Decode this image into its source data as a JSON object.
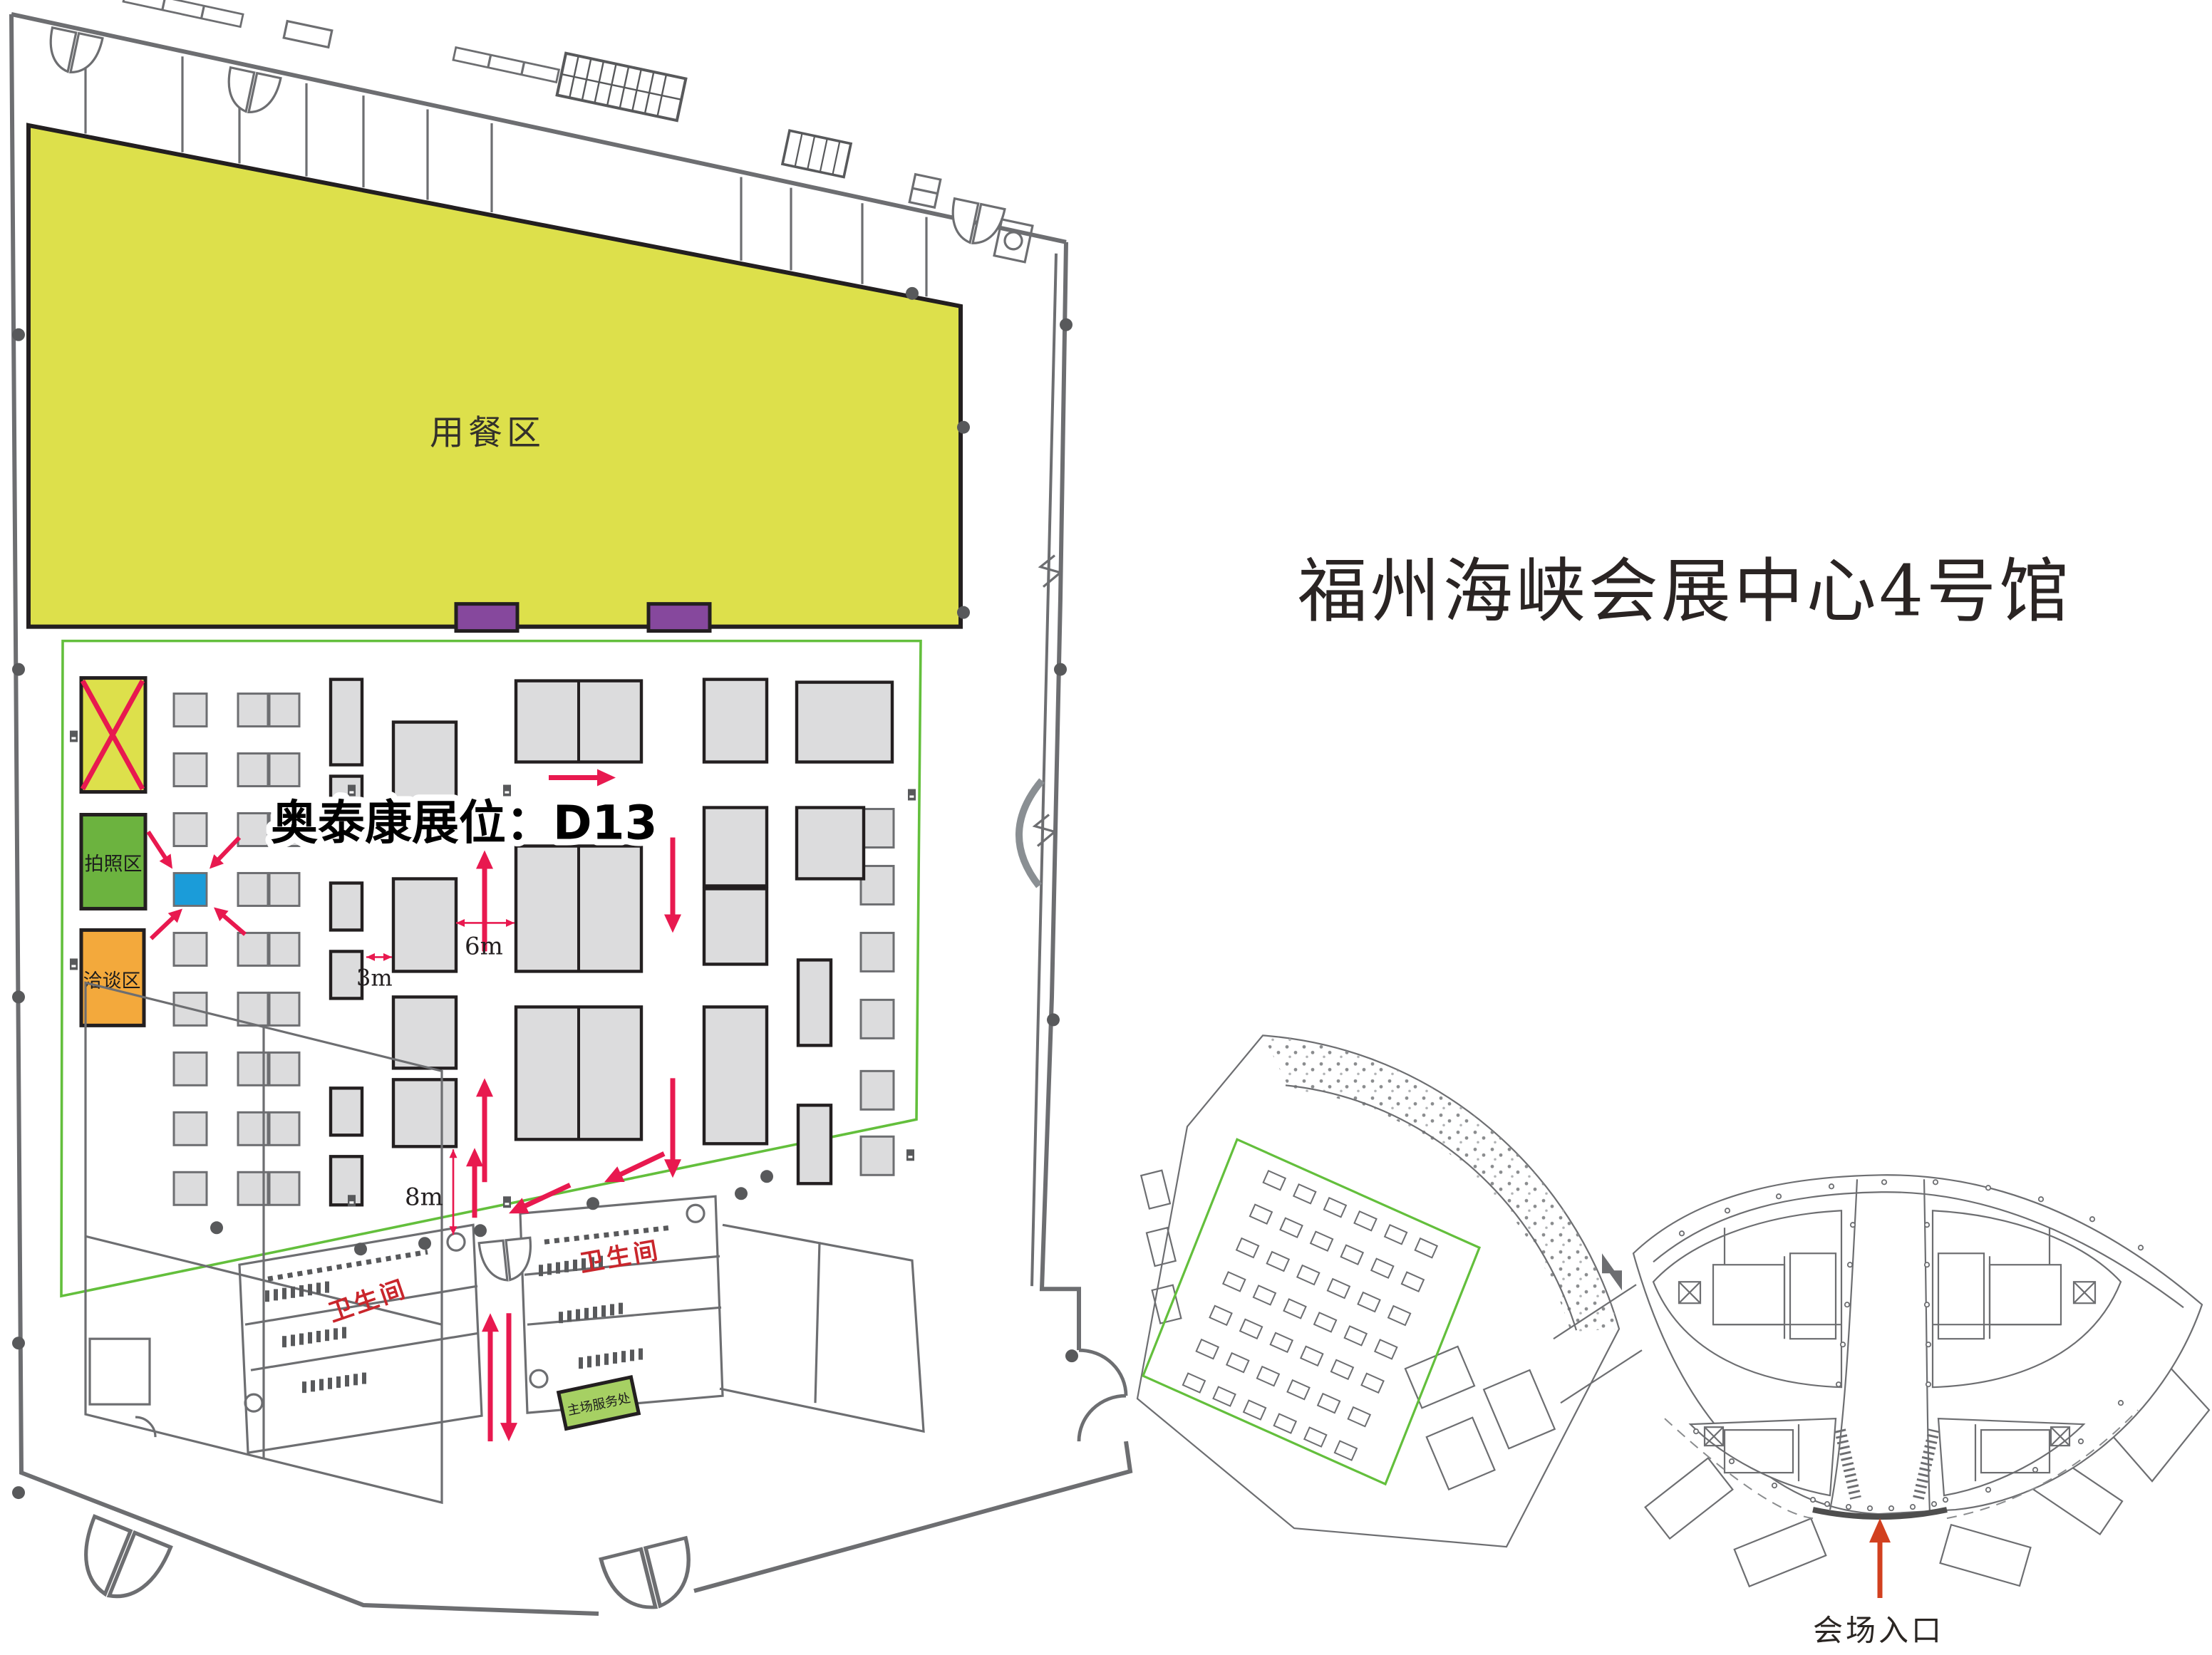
{
  "title": "福州海峡会展中心4号馆",
  "floor_plan": {
    "dining_label": "用餐区",
    "photo_label": "拍照区",
    "talk_label": "洽谈区",
    "callout": "奥泰康展位：D13",
    "restroom_left": "卫生间",
    "restroom_right": "卫生间",
    "service_label": "主场服务处",
    "dim_3m": "3m",
    "dim_6m": "6m",
    "dim_8m": "8m"
  },
  "overview": {
    "entrance_label": "会场入口"
  },
  "colors": {
    "dining": "#dde04b",
    "photo": "#6cb33f",
    "talk": "#f3a93c",
    "booth_highlight": "#1b9cd9",
    "route": "#e8194f",
    "purple": "#86489d",
    "boundary": "#63bf3c",
    "entrance_arrow": "#d2401f",
    "wall": "#6d6e71",
    "booth_fill": "#dcdcdd",
    "booth_dark": "#231f20",
    "restroom_text": "#c9262c",
    "service_fill": "#a6d063",
    "title_color": "#2a2423"
  }
}
